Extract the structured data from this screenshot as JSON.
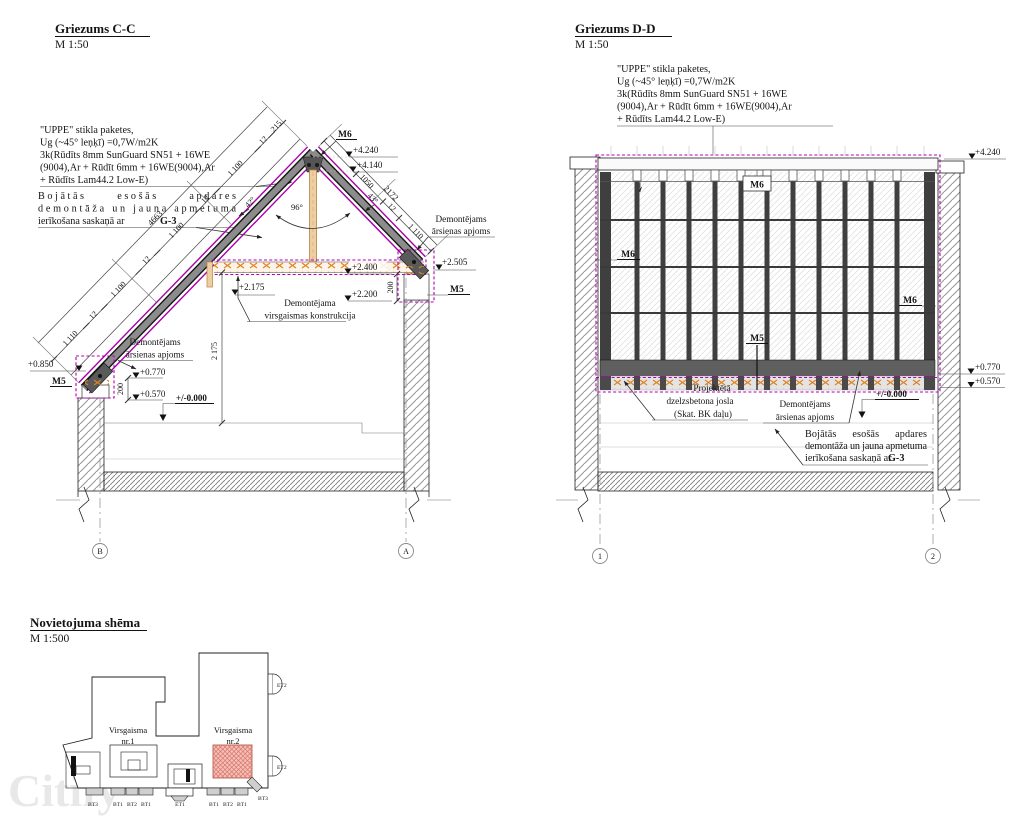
{
  "watermark": "Citify",
  "notes": {
    "glass": [
      "\"UPPE\" stikla paketes,",
      "Ug (~45° leņķī) =0,7W/m2K",
      "3k(Rūdīts 8mm SunGuard SN51 + 16WE",
      "(9004),Ar + Rūdīt 6mm + 16WE(9004),Ar",
      "+ Rūdīts Lam44.2 Low-E)"
    ],
    "repair": [
      "Bojātās      esošās      apdares",
      "demontāža un jauna apmetuma",
      "ierīkošana saskaņā ar"
    ],
    "repair_bold": "G-3"
  },
  "cc": {
    "title": "Griezums C-C",
    "scale": "M 1:50",
    "levels": {
      "l4240": "+4.240",
      "l4140": "+4.140",
      "l2505": "+2.505",
      "l2400": "+2.400",
      "l2175": "+2.175",
      "l2200": "+2.200",
      "l0850": "+0.850",
      "l0770": "+0.770",
      "l0570": "+0.570",
      "l0000": "+/-0.000"
    },
    "marks": {
      "m6": "M6",
      "m5r": "M5",
      "m5l": "M5"
    },
    "dims": {
      "chain": [
        "215",
        "12",
        "1 100",
        "12",
        "1 100",
        "12",
        "1 100",
        "12",
        "1 110"
      ],
      "total": "4663",
      "right": [
        "1050",
        "12",
        "1 110",
        "2172"
      ],
      "a42": "42°",
      "a43": "43°",
      "a96": "96°",
      "d200": "200",
      "d2175": "2 175"
    },
    "demont_right": [
      "Demontējams",
      "ārsienas apjoms"
    ],
    "demont_left": [
      "Demontējams",
      "ārsienas apjoms"
    ],
    "demont_sky": [
      "Demontējama",
      "virsgaismas konstrukcija"
    ],
    "grid": {
      "b": "B",
      "a": "A"
    }
  },
  "dd": {
    "title": "Griezums D-D",
    "scale": "M 1:50",
    "levels": {
      "l4240": "+4.240",
      "l0770": "+0.770",
      "l0570": "+0.570",
      "l0000": "+/-0.000"
    },
    "marks": {
      "m6_top": "M6",
      "m6_left": "M6",
      "m6_right": "M6",
      "m5": "M5"
    },
    "josla": [
      "Projektētā",
      "dzelzsbetona josla",
      "(Skat. BK daļu)"
    ],
    "demont": [
      "Demontējams",
      "ārsienas apjoms"
    ],
    "grid": {
      "g1": "1",
      "g2": "2"
    }
  },
  "site": {
    "title": "Novietojuma shēma",
    "scale": "M 1:500",
    "sky1": [
      "Virsgaisma",
      "nr.1"
    ],
    "sky2": [
      "Virsgaisma",
      "nr.2"
    ],
    "tags": [
      "BT3",
      "BT1",
      "BT2",
      "BT1",
      "ET1",
      "BT1",
      "BT2",
      "BT1",
      "BT3"
    ],
    "et2": "ET2"
  }
}
